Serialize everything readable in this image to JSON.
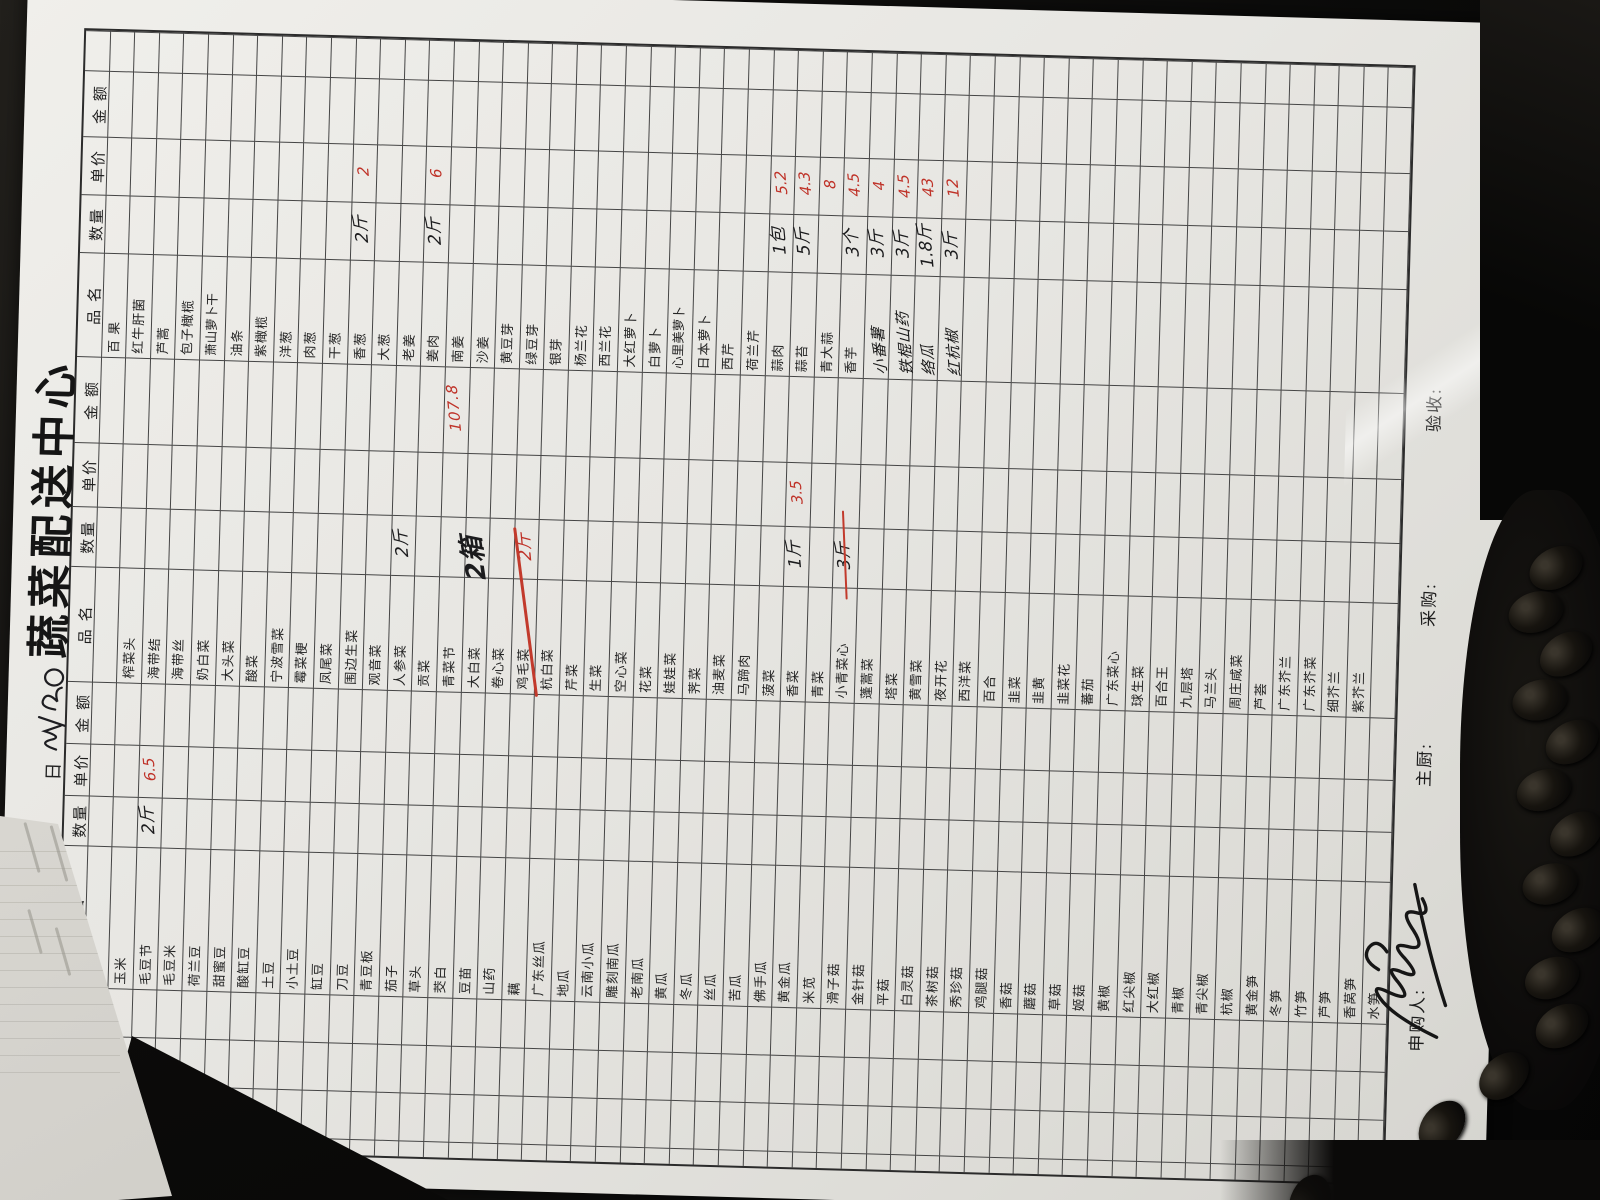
{
  "title": "蔬菜配送中心",
  "date": {
    "label": "日",
    "scribble": "3/30"
  },
  "ink": {
    "red": "#bf3228",
    "black": "#1b1b1d",
    "paper": "#e7e6e2",
    "desk": "#0a0a09"
  },
  "table": {
    "header": {
      "name": "品  名",
      "qty": "数量",
      "price": "单价",
      "amount": "金  额"
    },
    "groups": [
      {
        "id": "g1",
        "items": []
      },
      {
        "id": "g2",
        "first_row": "",
        "items": [
          {
            "n": "玉米"
          },
          {
            "n": "毛豆节",
            "q": "2斤",
            "p": "6.5"
          },
          {
            "n": "毛豆米"
          },
          {
            "n": "荷兰豆"
          },
          {
            "n": "甜蜜豆"
          },
          {
            "n": "酸缸豆"
          },
          {
            "n": "土豆"
          },
          {
            "n": "小土豆"
          },
          {
            "n": "缸豆"
          },
          {
            "n": "刀豆"
          },
          {
            "n": "青豆板"
          },
          {
            "n": "茄子"
          },
          {
            "n": "草头"
          },
          {
            "n": "茭白"
          },
          {
            "n": "豆苗"
          },
          {
            "n": "山药"
          },
          {
            "n": "藕"
          },
          {
            "n": "广东丝瓜"
          },
          {
            "n": "地瓜"
          },
          {
            "n": "云南小瓜"
          },
          {
            "n": "雕刻南瓜"
          },
          {
            "n": "老南瓜"
          },
          {
            "n": "黄瓜"
          },
          {
            "n": "冬瓜"
          },
          {
            "n": "丝瓜"
          },
          {
            "n": "苦瓜"
          },
          {
            "n": "佛手瓜"
          },
          {
            "n": "黄金瓜"
          },
          {
            "n": "米苋"
          },
          {
            "n": "滑子菇"
          },
          {
            "n": "金针菇"
          },
          {
            "n": "平菇"
          },
          {
            "n": "白灵菇"
          },
          {
            "n": "茶树菇"
          },
          {
            "n": "秀珍菇"
          },
          {
            "n": "鸡腿菇"
          },
          {
            "n": "香菇"
          },
          {
            "n": "蘑菇"
          },
          {
            "n": "草菇"
          },
          {
            "n": "姬菇"
          },
          {
            "n": "黄椒"
          },
          {
            "n": "红尖椒"
          },
          {
            "n": "大红椒"
          },
          {
            "n": "青椒"
          },
          {
            "n": "青尖椒"
          },
          {
            "n": "杭椒"
          },
          {
            "n": "黄金笋"
          },
          {
            "n": "冬笋"
          },
          {
            "n": "竹笋"
          },
          {
            "n": "芦笋"
          },
          {
            "n": "香莴笋"
          },
          {
            "n": "水笋"
          }
        ]
      },
      {
        "id": "g3",
        "first_row": "",
        "items": [
          {
            "n": "榨菜头"
          },
          {
            "n": "海带结"
          },
          {
            "n": "海带丝"
          },
          {
            "n": "奶白菜"
          },
          {
            "n": "大头菜"
          },
          {
            "n": "酸菜"
          },
          {
            "n": "宁波雪菜"
          },
          {
            "n": "霉菜梗"
          },
          {
            "n": "凤尾菜"
          },
          {
            "n": "围边生菜"
          },
          {
            "n": "观音菜"
          },
          {
            "n": "人参菜",
            "q": "2斤"
          },
          {
            "n": "贡菜"
          },
          {
            "n": "青菜节",
            "a": "107.8"
          },
          {
            "n": "大白菜",
            "q": "2箱",
            "f": "big"
          },
          {
            "n": "卷心菜"
          },
          {
            "n": "鸡毛菜",
            "q": "2斤",
            "qc": "r",
            "f": "strike"
          },
          {
            "n": "杭白菜"
          },
          {
            "n": "芹菜"
          },
          {
            "n": "生菜"
          },
          {
            "n": "空心菜"
          },
          {
            "n": "花菜"
          },
          {
            "n": "娃娃菜"
          },
          {
            "n": "荠菜"
          },
          {
            "n": "油麦菜"
          },
          {
            "n": "马蹄肉"
          },
          {
            "n": "菠菜"
          },
          {
            "n": "香菜",
            "q": "1斤",
            "p": "3.5"
          },
          {
            "n": "青菜"
          },
          {
            "n": "小青菜心",
            "q": "3斤",
            "f": "redline"
          },
          {
            "n": "蓬蒿菜"
          },
          {
            "n": "塔菜"
          },
          {
            "n": "黄雪菜"
          },
          {
            "n": "夜开花"
          },
          {
            "n": "西洋菜"
          },
          {
            "n": "百合"
          },
          {
            "n": "韭菜"
          },
          {
            "n": "韭黄"
          },
          {
            "n": "韭菜花"
          },
          {
            "n": "蕃茄"
          },
          {
            "n": "广东菜心"
          },
          {
            "n": "球生菜"
          },
          {
            "n": "百合王"
          },
          {
            "n": "九层塔"
          },
          {
            "n": "马兰头"
          },
          {
            "n": "周庄咸菜"
          },
          {
            "n": "芦荟"
          },
          {
            "n": "广东芥兰"
          },
          {
            "n": "广东芥菜"
          },
          {
            "n": "细芥兰"
          },
          {
            "n": "紫芥兰"
          }
        ]
      },
      {
        "id": "g4",
        "first_row": "百 果",
        "items": [
          {
            "n": "红牛肝菌"
          },
          {
            "n": "芦蒿"
          },
          {
            "n": "包子橄榄"
          },
          {
            "n": "萧山萝卜干"
          },
          {
            "n": "油条"
          },
          {
            "n": "紫橄榄"
          },
          {
            "n": "洋葱"
          },
          {
            "n": "肉葱"
          },
          {
            "n": "干葱"
          },
          {
            "n": "香葱",
            "q": "2斤",
            "p": "2"
          },
          {
            "n": "大葱"
          },
          {
            "n": "老姜"
          },
          {
            "n": "姜肉",
            "q": "2斤",
            "p": "6"
          },
          {
            "n": "南姜"
          },
          {
            "n": "沙姜"
          },
          {
            "n": "黄豆芽"
          },
          {
            "n": "绿豆芽"
          },
          {
            "n": "银芽"
          },
          {
            "n": "杨兰花"
          },
          {
            "n": "西兰花"
          },
          {
            "n": "大红萝卜"
          },
          {
            "n": "白萝卜"
          },
          {
            "n": "心里美萝卜"
          },
          {
            "n": "日本萝卜"
          },
          {
            "n": "西芹"
          },
          {
            "n": "荷兰芹"
          },
          {
            "n": "蒜肉",
            "q": "1包",
            "p": "5.2"
          },
          {
            "n": "蒜苔",
            "q": "5斤",
            "p": "4.3"
          },
          {
            "n": "青大蒜",
            "p": "8"
          },
          {
            "n": "香芋",
            "q": "3个",
            "p": "4.5"
          },
          {
            "n": "小番薯",
            "q": "3斤",
            "p": "4",
            "f": "hw"
          },
          {
            "n": "铁棍山药",
            "q": "3斤",
            "p": "4.5",
            "f": "hw"
          },
          {
            "n": "络瓜",
            "q": "1.8斤",
            "p": "43",
            "f": "hw"
          },
          {
            "n": "红杭椒",
            "q": "3斤",
            "p": "12",
            "f": "hw"
          }
        ]
      }
    ]
  },
  "footer": {
    "requester": "申购人:",
    "chef": "主厨:",
    "purchaser": "采购:",
    "inspector": "验收:"
  }
}
